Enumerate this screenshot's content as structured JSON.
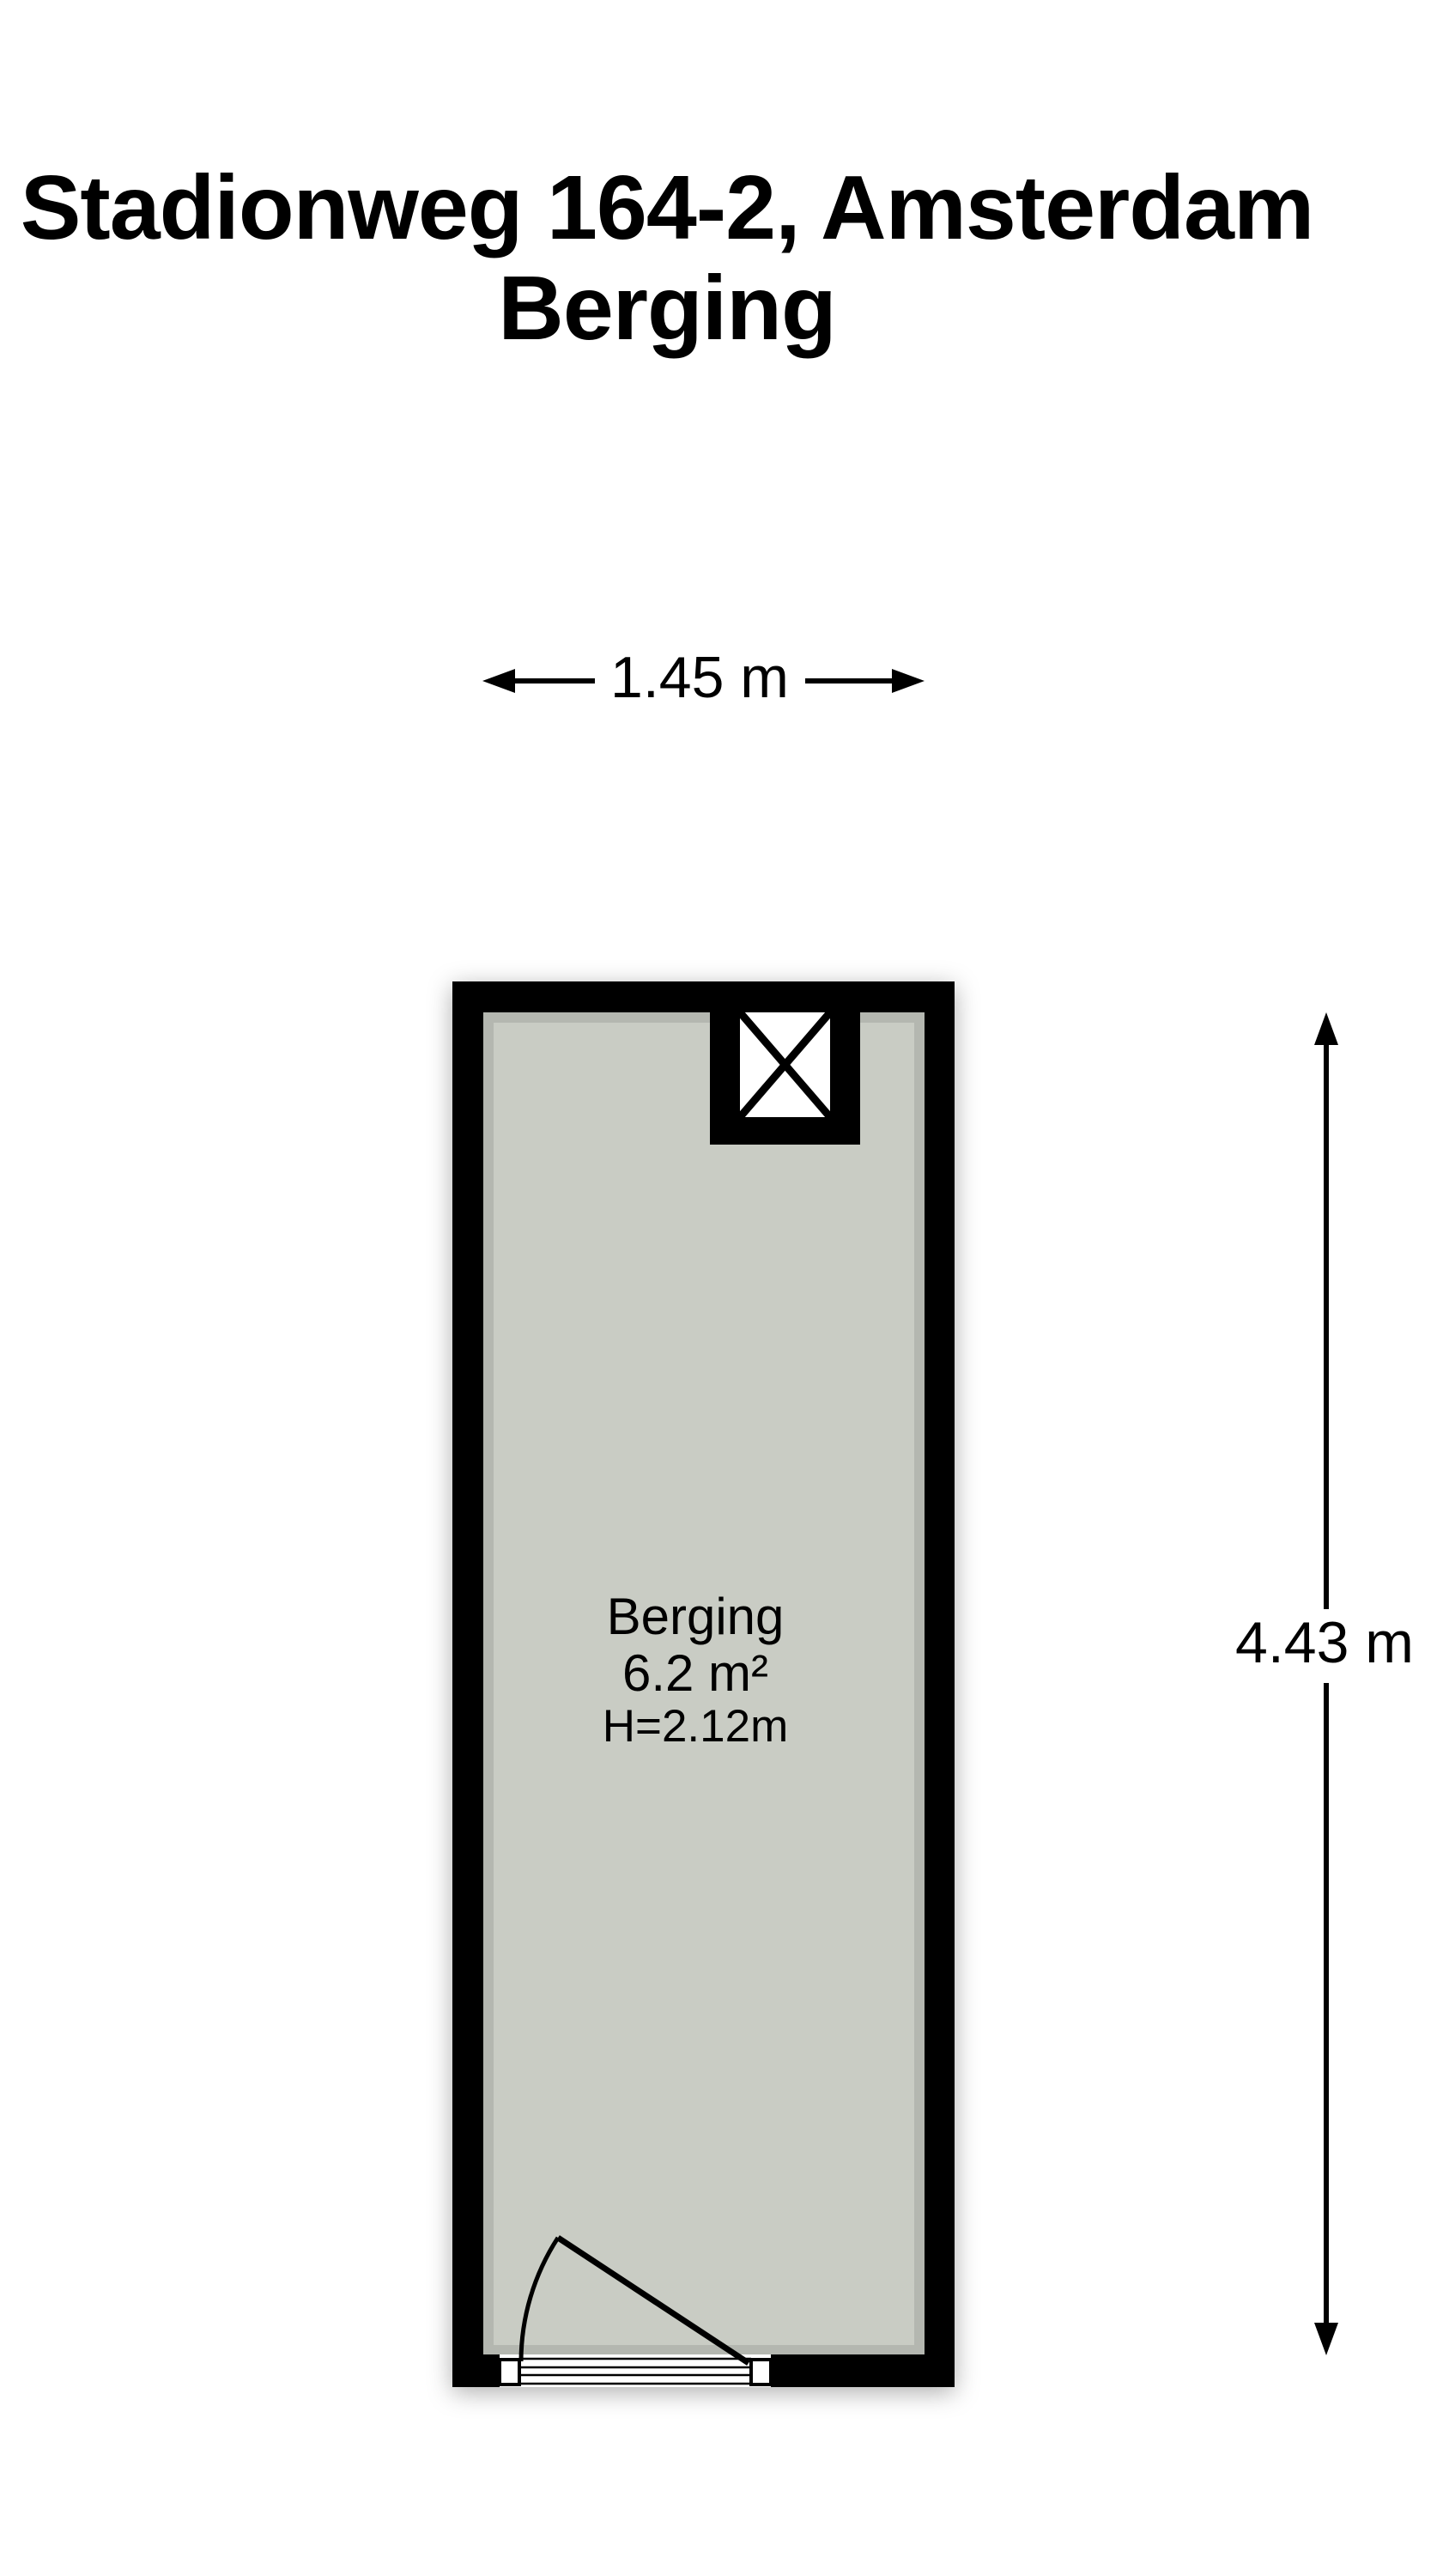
{
  "title": {
    "line1": "Stadionweg 164-2, Amsterdam",
    "line2": "Berging"
  },
  "room_label": {
    "name": "Berging",
    "area": "6.2 m²",
    "ceiling_height": "H=2.12m"
  },
  "dimensions": {
    "width_label": "1.45 m",
    "height_label": "4.43 m"
  },
  "colors": {
    "wall_black": "#000000",
    "floor_gray": "#c9ccc4",
    "shaft_white": "#ffffff",
    "page_white": "#ffffff",
    "ink_black": "#000000"
  },
  "icons": {
    "shaft_icon": "crossed-box ☒ (duct/shaft symbol)",
    "width_dimension_icon": "double-headed horizontal arrow ↔",
    "height_dimension_icon": "double-headed vertical arrow ↕",
    "door_icon": "quarter-swing door arc"
  }
}
